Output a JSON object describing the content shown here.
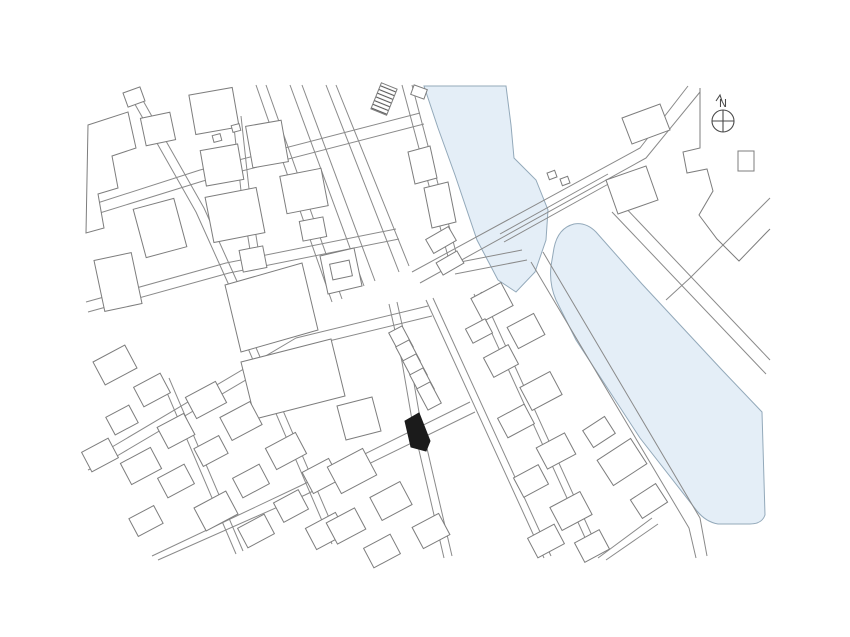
{
  "page": {
    "title": "Site vicinity plan",
    "background": "#ffffff"
  },
  "map": {
    "canvas": {
      "width": 850,
      "height": 637
    },
    "colors": {
      "line": "#8a8a8a",
      "building_line": "#7d7d7d",
      "building_fill": "#ffffff",
      "water_fill": "#e4eef7",
      "water_edge": "#93a9ba",
      "site_fill": "#1b1b1b",
      "hatch_line": "#5a5a5a",
      "north": "#4a4a4a"
    },
    "water": [
      {
        "name": "upper-canal",
        "d": "M 424,86 L 506,86 L 511,125 L 514,158 L 536,180 L 548,210 L 546,240 L 535,272 L 516,292 L 498,280 L 477,240 L 455,175 L 438,128 Z"
      },
      {
        "name": "river",
        "d": "M 554,248 Q 558,228 574,224 Q 586,222 596,232 L 642,284 L 722,370 L 762,412 L 765,515 Q 762,524 750,524 L 718,524 Q 706,522 697,511 L 640,438 L 576,340 L 556,300 Q 549,284 551,266 Z"
      }
    ],
    "roads": [
      {
        "name": "avenue-north",
        "d": "M 256,85 L 332,302"
      },
      {
        "name": "avenue-north",
        "d": "M 266,85 L 342,299"
      },
      {
        "name": "avenue-north",
        "d": "M 290,85 L 364,286"
      },
      {
        "name": "avenue-north",
        "d": "M 302,85 L 375,281"
      },
      {
        "name": "avenue-north",
        "d": "M 326,85 L 399,272"
      },
      {
        "name": "avenue-north",
        "d": "M 336,85 L 409,266"
      },
      {
        "name": "canal-bank-road",
        "d": "M 402,85 L 450,264"
      },
      {
        "name": "canal-bank-road",
        "d": "M 412,85 L 458,260"
      },
      {
        "name": "avenue-south",
        "d": "M 426,300 L 544,558"
      },
      {
        "name": "avenue-south",
        "d": "M 433,298 L 551,556"
      },
      {
        "name": "avenue-south",
        "d": "M 474,294 L 592,553"
      },
      {
        "name": "avenue-south",
        "d": "M 481,292 L 599,551"
      },
      {
        "name": "northeast-road",
        "d": "M 412,272 L 640,148 L 688,86"
      },
      {
        "name": "northeast-road",
        "d": "M 420,283 L 646,158 L 700,92"
      },
      {
        "name": "northeast-road-median",
        "d": "M 500,234 L 608,174"
      },
      {
        "name": "northeast-road-median",
        "d": "M 504,242 L 612,182"
      },
      {
        "name": "riverbank-road-west",
        "d": "M 543,252 L 700,518 L 707,556"
      },
      {
        "name": "riverbank-road-west",
        "d": "M 531,262 L 689,528 L 696,558"
      },
      {
        "name": "riverbank-road-east",
        "d": "M 612,212 L 766,374"
      },
      {
        "name": "riverbank-road-east",
        "d": "M 621,203 L 770,360"
      },
      {
        "name": "southwest-road",
        "d": "M 428,306 L 296,338 L 112,447 L 86,460"
      },
      {
        "name": "southwest-road",
        "d": "M 432,316 L 300,348 L 117,456 L 88,470"
      },
      {
        "name": "southwest-road-2",
        "d": "M 470,402 L 300,486 L 152,556"
      },
      {
        "name": "southwest-road-2",
        "d": "M 475,412 L 305,495 L 158,560"
      },
      {
        "name": "cross-street",
        "d": "M 247,346 L 332,544"
      },
      {
        "name": "cross-street",
        "d": "M 254,343 L 339,541"
      },
      {
        "name": "cross-street",
        "d": "M 162,381 L 236,554"
      },
      {
        "name": "cross-street",
        "d": "M 169,378 L 243,551"
      },
      {
        "name": "northwest-lane",
        "d": "M 128,92 L 196,212 L 232,292"
      },
      {
        "name": "northwest-lane",
        "d": "M 137,90 L 204,208 L 240,288"
      },
      {
        "name": "upper-west-road",
        "d": "M 88,206 L 200,170 L 420,113"
      },
      {
        "name": "upper-west-road",
        "d": "M 90,216 L 203,181 L 424,124"
      },
      {
        "name": "short-lane",
        "d": "M 233,118 L 242,200 L 250,250"
      },
      {
        "name": "short-lane",
        "d": "M 241,116 L 250,198 L 258,248"
      },
      {
        "name": "mid-west-road",
        "d": "M 86,302 L 226,263 L 396,229"
      },
      {
        "name": "mid-west-road",
        "d": "M 88,312 L 229,273 L 399,239"
      },
      {
        "name": "site-lane",
        "d": "M 389,304 L 402,362 L 412,420 L 424,472 L 444,558"
      },
      {
        "name": "site-lane",
        "d": "M 397,302 L 410,360 L 420,418 L 432,470 L 452,556"
      },
      {
        "name": "parcel-boundary-ne",
        "d": "M 770,198 L 690,278 L 666,300"
      },
      {
        "name": "bridge-connector",
        "d": "M 450,264 L 522,250"
      },
      {
        "name": "bridge-connector",
        "d": "M 455,274 L 527,260"
      },
      {
        "name": "south-stub",
        "d": "M 598,558 L 652,518"
      },
      {
        "name": "south-stub",
        "d": "M 606,560 L 658,524"
      }
    ],
    "buildings": [
      {
        "d": "M 88,125 L 128,112 L 136,148 L 112,156 L 118,188 L 98,194 L 104,228 L 86,233 Z"
      },
      {
        "cx": 160,
        "cy": 228,
        "w": 42,
        "h": 50,
        "a": -15
      },
      {
        "cx": 118,
        "cy": 282,
        "w": 38,
        "h": 52,
        "a": -12
      },
      {
        "cx": 158,
        "cy": 129,
        "w": 30,
        "h": 28,
        "a": -12
      },
      {
        "cx": 214,
        "cy": 111,
        "w": 44,
        "h": 40,
        "a": -10
      },
      {
        "cx": 267,
        "cy": 144,
        "w": 36,
        "h": 42,
        "a": -10
      },
      {
        "cx": 222,
        "cy": 165,
        "w": 38,
        "h": 36,
        "a": -10
      },
      {
        "cx": 235,
        "cy": 215,
        "w": 52,
        "h": 46,
        "a": -11
      },
      {
        "cx": 253,
        "cy": 259,
        "w": 24,
        "h": 22,
        "a": -11
      },
      {
        "cx": 304,
        "cy": 191,
        "w": 42,
        "h": 38,
        "a": -11
      },
      {
        "cx": 313,
        "cy": 229,
        "w": 24,
        "h": 20,
        "a": -11
      },
      {
        "cx": 134,
        "cy": 97,
        "w": 18,
        "h": 15,
        "a": -20
      },
      {
        "d": "M 225,285 L 302,263 L 318,330 L 241,352 Z"
      },
      {
        "d": "M 320,256 L 354,248 L 362,286 L 328,294 Z"
      },
      {
        "cx": 341,
        "cy": 270,
        "w": 20,
        "h": 16,
        "a": -12
      },
      {
        "d": "M 241,362 L 331,339 L 345,396 L 255,419 Z"
      },
      {
        "d": "M 337,406 L 372,397 L 381,431 L 346,440 Z"
      },
      {
        "cx": 115,
        "cy": 365,
        "w": 36,
        "h": 26,
        "a": -28
      },
      {
        "cx": 152,
        "cy": 390,
        "w": 30,
        "h": 22,
        "a": -28
      },
      {
        "cx": 122,
        "cy": 420,
        "w": 26,
        "h": 20,
        "a": -28
      },
      {
        "cx": 100,
        "cy": 455,
        "w": 30,
        "h": 22,
        "a": -28
      },
      {
        "cx": 141,
        "cy": 466,
        "w": 34,
        "h": 24,
        "a": -28
      },
      {
        "cx": 176,
        "cy": 431,
        "w": 30,
        "h": 24,
        "a": -28
      },
      {
        "cx": 206,
        "cy": 400,
        "w": 34,
        "h": 24,
        "a": -28
      },
      {
        "cx": 176,
        "cy": 481,
        "w": 30,
        "h": 22,
        "a": -28
      },
      {
        "cx": 211,
        "cy": 451,
        "w": 28,
        "h": 20,
        "a": -28
      },
      {
        "cx": 241,
        "cy": 421,
        "w": 34,
        "h": 26,
        "a": -28
      },
      {
        "cx": 216,
        "cy": 511,
        "w": 36,
        "h": 26,
        "a": -28
      },
      {
        "cx": 251,
        "cy": 481,
        "w": 30,
        "h": 22,
        "a": -28
      },
      {
        "cx": 286,
        "cy": 451,
        "w": 34,
        "h": 24,
        "a": -28
      },
      {
        "cx": 256,
        "cy": 531,
        "w": 30,
        "h": 22,
        "a": -28
      },
      {
        "cx": 291,
        "cy": 506,
        "w": 28,
        "h": 22,
        "a": -28
      },
      {
        "cx": 321,
        "cy": 476,
        "w": 30,
        "h": 24,
        "a": -28
      },
      {
        "cx": 326,
        "cy": 531,
        "w": 34,
        "h": 24,
        "a": -28
      },
      {
        "cx": 146,
        "cy": 521,
        "w": 28,
        "h": 20,
        "a": -28
      },
      {
        "cx": 352,
        "cy": 471,
        "w": 40,
        "h": 30,
        "a": -28
      },
      {
        "cx": 391,
        "cy": 501,
        "w": 34,
        "h": 26,
        "a": -28
      },
      {
        "cx": 431,
        "cy": 531,
        "w": 30,
        "h": 24,
        "a": -28
      },
      {
        "cx": 346,
        "cy": 526,
        "w": 32,
        "h": 24,
        "a": -28
      },
      {
        "cx": 382,
        "cy": 551,
        "w": 30,
        "h": 22,
        "a": -28
      },
      {
        "cx": 401,
        "cy": 340,
        "w": 24,
        "h": 15,
        "a": 62
      },
      {
        "cx": 408,
        "cy": 354,
        "w": 24,
        "h": 15,
        "a": 62
      },
      {
        "cx": 415,
        "cy": 368,
        "w": 24,
        "h": 15,
        "a": 62
      },
      {
        "cx": 422,
        "cy": 382,
        "w": 24,
        "h": 15,
        "a": 62
      },
      {
        "cx": 429,
        "cy": 396,
        "w": 24,
        "h": 15,
        "a": 62
      },
      {
        "d": "M 408,152 L 430,146 L 437,178 L 415,184 Z"
      },
      {
        "d": "M 424,188 L 448,182 L 456,222 L 432,228 Z"
      },
      {
        "cx": 441,
        "cy": 240,
        "w": 26,
        "h": 16,
        "a": -30
      },
      {
        "cx": 450,
        "cy": 263,
        "w": 24,
        "h": 14,
        "a": -30
      },
      {
        "cx": 492,
        "cy": 302,
        "w": 34,
        "h": 26,
        "a": -28
      },
      {
        "cx": 526,
        "cy": 331,
        "w": 30,
        "h": 24,
        "a": -28
      },
      {
        "cx": 501,
        "cy": 361,
        "w": 28,
        "h": 22,
        "a": -28
      },
      {
        "cx": 541,
        "cy": 391,
        "w": 34,
        "h": 26,
        "a": -28
      },
      {
        "cx": 516,
        "cy": 421,
        "w": 30,
        "h": 22,
        "a": -28
      },
      {
        "cx": 556,
        "cy": 451,
        "w": 32,
        "h": 24,
        "a": -28
      },
      {
        "cx": 531,
        "cy": 481,
        "w": 28,
        "h": 22,
        "a": -28
      },
      {
        "cx": 571,
        "cy": 511,
        "w": 34,
        "h": 26,
        "a": -28
      },
      {
        "cx": 546,
        "cy": 541,
        "w": 30,
        "h": 22,
        "a": -28
      },
      {
        "cx": 592,
        "cy": 546,
        "w": 28,
        "h": 22,
        "a": -28
      },
      {
        "cx": 479,
        "cy": 331,
        "w": 22,
        "h": 16,
        "a": -28
      },
      {
        "cx": 622,
        "cy": 462,
        "w": 40,
        "h": 30,
        "a": -33
      },
      {
        "cx": 599,
        "cy": 432,
        "w": 26,
        "h": 20,
        "a": -33
      },
      {
        "cx": 649,
        "cy": 501,
        "w": 30,
        "h": 22,
        "a": -33
      },
      {
        "d": "M 606,180 L 646,166 L 658,200 L 618,214 Z"
      },
      {
        "d": "M 622,118 L 660,104 L 670,130 L 632,144 Z"
      },
      {
        "d": "M 700,88 L 700,148 L 683,152 L 687,173 L 707,169 L 713,191 L 699,215 L 717,239 L 739,261 L 766,233 L 770,229",
        "open": true
      },
      {
        "cx": 746,
        "cy": 161,
        "w": 16,
        "h": 20,
        "a": 0
      },
      {
        "cx": 552,
        "cy": 175,
        "w": 8,
        "h": 7,
        "a": -20
      },
      {
        "cx": 565,
        "cy": 181,
        "w": 8,
        "h": 7,
        "a": -20
      },
      {
        "cx": 217,
        "cy": 138,
        "w": 8,
        "h": 7,
        "a": -15
      },
      {
        "cx": 236,
        "cy": 128,
        "w": 8,
        "h": 7,
        "a": -15
      },
      {
        "cx": 419,
        "cy": 92,
        "w": 14,
        "h": 10,
        "a": 20
      }
    ],
    "hatched_building": {
      "cx": 384,
      "cy": 99,
      "w": 17,
      "h": 28,
      "a": 22
    },
    "site_marker": {
      "d": "M 405,421 L 419,413 L 430,441 L 426,451 L 411,447 Z"
    },
    "north_arrow": {
      "cx": 723,
      "cy": 121,
      "r": 11,
      "label": "N"
    }
  }
}
